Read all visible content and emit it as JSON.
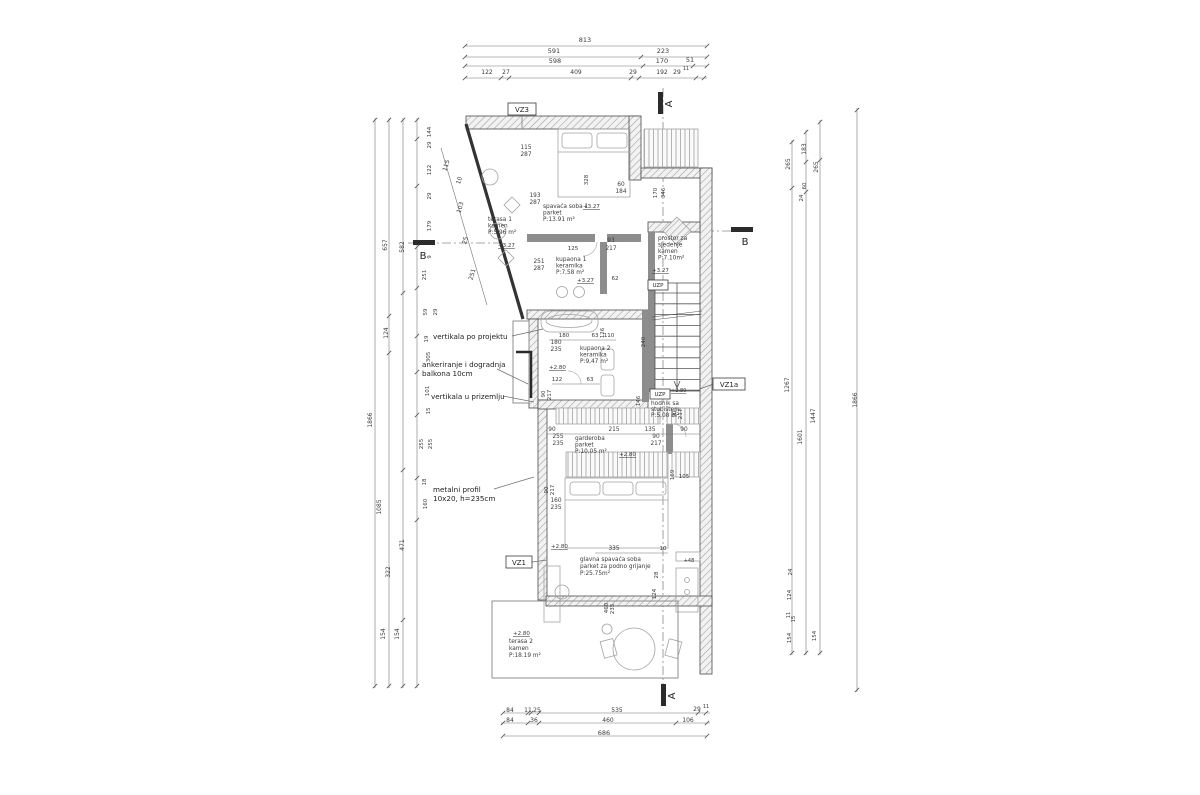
{
  "drawing": {
    "type": "floor-plan",
    "language": "hr"
  },
  "colors": {
    "text": "#3a3a3a",
    "dark": "#222222",
    "line": "#6e6e6e",
    "wall": "#4a4a4a",
    "light": "#a9a9a9",
    "accent": "#000000"
  },
  "dim_labels": [
    {
      "t": "813",
      "x": 585,
      "y": 42,
      "s": 6.5
    },
    {
      "t": "591",
      "x": 554,
      "y": 53,
      "s": 6.5
    },
    {
      "t": "223",
      "x": 663,
      "y": 53,
      "s": 6.5
    },
    {
      "t": "598",
      "x": 555,
      "y": 63,
      "s": 6.5
    },
    {
      "t": "170",
      "x": 662,
      "y": 63,
      "s": 6.5
    },
    {
      "t": "51",
      "x": 690,
      "y": 62,
      "s": 6.5
    },
    {
      "t": "122",
      "x": 487,
      "y": 74,
      "s": 6
    },
    {
      "t": "27",
      "x": 506,
      "y": 74,
      "s": 6
    },
    {
      "t": "409",
      "x": 576,
      "y": 74,
      "s": 6
    },
    {
      "t": "29",
      "x": 633,
      "y": 74,
      "s": 6
    },
    {
      "t": "192",
      "x": 662,
      "y": 74,
      "s": 6
    },
    {
      "t": "29",
      "x": 677,
      "y": 74,
      "s": 6
    },
    {
      "t": "11",
      "x": 686,
      "y": 70,
      "s": 5
    },
    {
      "t": "84",
      "x": 510,
      "y": 712,
      "s": 6
    },
    {
      "t": "11",
      "x": 528,
      "y": 712,
      "s": 6
    },
    {
      "t": "25",
      "x": 537,
      "y": 712,
      "s": 6
    },
    {
      "t": "535",
      "x": 617,
      "y": 712,
      "s": 6
    },
    {
      "t": "29",
      "x": 697,
      "y": 711,
      "s": 6
    },
    {
      "t": "11",
      "x": 706,
      "y": 708,
      "s": 5
    },
    {
      "t": "84",
      "x": 510,
      "y": 722,
      "s": 6
    },
    {
      "t": "36",
      "x": 534,
      "y": 722,
      "s": 6
    },
    {
      "t": "460",
      "x": 608,
      "y": 722,
      "s": 6
    },
    {
      "t": "106",
      "x": 688,
      "y": 722,
      "s": 6
    },
    {
      "t": "686",
      "x": 604,
      "y": 735,
      "s": 6.5
    },
    {
      "t": "1866",
      "x": 372,
      "y": 420,
      "r": -90,
      "s": 6
    },
    {
      "t": "657",
      "x": 387,
      "y": 245,
      "r": -90,
      "s": 6
    },
    {
      "t": "124",
      "x": 388,
      "y": 333,
      "r": -90,
      "s": 6
    },
    {
      "t": "1085",
      "x": 381,
      "y": 507,
      "r": -90,
      "s": 6
    },
    {
      "t": "322",
      "x": 390,
      "y": 572,
      "r": -90,
      "s": 6
    },
    {
      "t": "154",
      "x": 385,
      "y": 634,
      "r": -90,
      "s": 6
    },
    {
      "t": "582",
      "x": 404,
      "y": 247,
      "r": -90,
      "s": 6
    },
    {
      "t": "471",
      "x": 404,
      "y": 545,
      "r": -90,
      "s": 6
    },
    {
      "t": "154",
      "x": 399,
      "y": 634,
      "r": -90,
      "s": 6
    },
    {
      "t": "144",
      "x": 431,
      "y": 132,
      "r": -90,
      "s": 5.5
    },
    {
      "t": "29",
      "x": 431,
      "y": 145,
      "r": -90,
      "s": 5.5
    },
    {
      "t": "122",
      "x": 431,
      "y": 170,
      "r": -90,
      "s": 5.5
    },
    {
      "t": "29",
      "x": 431,
      "y": 196,
      "r": -90,
      "s": 5.5
    },
    {
      "t": "179",
      "x": 431,
      "y": 226,
      "r": -90,
      "s": 5.5
    },
    {
      "t": "9",
      "x": 431,
      "y": 257,
      "r": -90,
      "s": 5.5
    },
    {
      "t": "251",
      "x": 426,
      "y": 275,
      "r": -90,
      "s": 5.5
    },
    {
      "t": "59",
      "x": 427,
      "y": 312,
      "r": -90,
      "s": 5.5
    },
    {
      "t": "29",
      "x": 437,
      "y": 312,
      "r": -90,
      "s": 5.5
    },
    {
      "t": "19",
      "x": 428,
      "y": 339,
      "r": -90,
      "s": 5.5
    },
    {
      "t": "305",
      "x": 430,
      "y": 357,
      "r": -90,
      "s": 5.5
    },
    {
      "t": "101",
      "x": 429,
      "y": 391,
      "r": -90,
      "s": 5.5
    },
    {
      "t": "15",
      "x": 430,
      "y": 411,
      "r": -90,
      "s": 5.5
    },
    {
      "t": "255",
      "x": 423,
      "y": 444,
      "r": -90,
      "s": 5.5
    },
    {
      "t": "255",
      "x": 432,
      "y": 444,
      "r": -90,
      "s": 5.5
    },
    {
      "t": "18",
      "x": 426,
      "y": 482,
      "r": -90,
      "s": 5.5
    },
    {
      "t": "160",
      "x": 427,
      "y": 504,
      "r": -90,
      "s": 5.5
    },
    {
      "t": "265",
      "x": 790,
      "y": 164,
      "r": -90,
      "s": 6
    },
    {
      "t": "183",
      "x": 806,
      "y": 149,
      "r": -90,
      "s": 6
    },
    {
      "t": "265",
      "x": 818,
      "y": 167,
      "r": -90,
      "s": 6
    },
    {
      "t": "60",
      "x": 806,
      "y": 186,
      "r": -90,
      "s": 5.5
    },
    {
      "t": "24",
      "x": 803,
      "y": 198,
      "r": -90,
      "s": 5.5
    },
    {
      "t": "1267",
      "x": 789,
      "y": 385,
      "r": -90,
      "s": 6
    },
    {
      "t": "1601",
      "x": 802,
      "y": 437,
      "r": -90,
      "s": 6
    },
    {
      "t": "1447",
      "x": 815,
      "y": 416,
      "r": -90,
      "s": 6
    },
    {
      "t": "1866",
      "x": 857,
      "y": 400,
      "r": -90,
      "s": 6
    },
    {
      "t": "24",
      "x": 792,
      "y": 572,
      "r": -90,
      "s": 5.5
    },
    {
      "t": "124",
      "x": 791,
      "y": 595,
      "r": -90,
      "s": 5.5
    },
    {
      "t": "11",
      "x": 790,
      "y": 615,
      "r": -90,
      "s": 5
    },
    {
      "t": "15",
      "x": 795,
      "y": 619,
      "r": -90,
      "s": 5
    },
    {
      "t": "154",
      "x": 791,
      "y": 638,
      "r": -90,
      "s": 5.5
    },
    {
      "t": "154",
      "x": 816,
      "y": 636,
      "r": -90,
      "s": 5.5
    },
    {
      "t": "115",
      "x": 448,
      "y": 166,
      "r": -73,
      "s": 6
    },
    {
      "t": "10",
      "x": 461,
      "y": 181,
      "r": -73,
      "s": 6
    },
    {
      "t": "103",
      "x": 462,
      "y": 208,
      "r": -73,
      "s": 6
    },
    {
      "t": "25",
      "x": 467,
      "y": 241,
      "r": -73,
      "s": 6
    },
    {
      "t": "251",
      "x": 474,
      "y": 275,
      "r": -73,
      "s": 6
    },
    {
      "t": "115",
      "x": 526,
      "y": 149,
      "s": 5.8
    },
    {
      "t": "287",
      "x": 526,
      "y": 156,
      "s": 5.8
    },
    {
      "t": "193",
      "x": 535,
      "y": 197,
      "s": 5.8
    },
    {
      "t": "287",
      "x": 535,
      "y": 204,
      "s": 5.8
    },
    {
      "t": "328",
      "x": 588,
      "y": 180,
      "r": -90,
      "s": 5.5
    },
    {
      "t": "60",
      "x": 621,
      "y": 186,
      "s": 5.8
    },
    {
      "t": "184",
      "x": 621,
      "y": 193,
      "s": 5.8
    },
    {
      "t": "170",
      "x": 657,
      "y": 193,
      "r": -90,
      "s": 5.5
    },
    {
      "t": "346",
      "x": 665,
      "y": 193,
      "r": -90,
      "s": 5.5
    },
    {
      "t": "251",
      "x": 539,
      "y": 263,
      "s": 5.8
    },
    {
      "t": "287",
      "x": 539,
      "y": 270,
      "s": 5.8
    },
    {
      "t": "125",
      "x": 573,
      "y": 250,
      "s": 5.5
    },
    {
      "t": "93",
      "x": 611,
      "y": 242,
      "s": 5.8
    },
    {
      "t": "217",
      "x": 611,
      "y": 250,
      "s": 5.8
    },
    {
      "t": "62",
      "x": 615,
      "y": 280,
      "s": 5.5
    },
    {
      "t": "180",
      "x": 564,
      "y": 337,
      "s": 5.5
    },
    {
      "t": "63",
      "x": 595,
      "y": 337,
      "s": 5.5
    },
    {
      "t": "110",
      "x": 609,
      "y": 337,
      "s": 5.5
    },
    {
      "t": "126",
      "x": 604,
      "y": 333,
      "r": -90,
      "s": 5.5
    },
    {
      "t": "240",
      "x": 645,
      "y": 342,
      "r": -90,
      "s": 5.5
    },
    {
      "t": "180",
      "x": 556,
      "y": 344,
      "s": 5.8
    },
    {
      "t": "235",
      "x": 556,
      "y": 351,
      "s": 5.8
    },
    {
      "t": "122",
      "x": 557,
      "y": 381,
      "s": 5.5
    },
    {
      "t": "63",
      "x": 590,
      "y": 381,
      "s": 5.5
    },
    {
      "t": "90",
      "x": 545,
      "y": 394,
      "r": -90,
      "s": 5.5
    },
    {
      "t": "217",
      "x": 551,
      "y": 395,
      "r": -90,
      "s": 5.5
    },
    {
      "t": "146",
      "x": 640,
      "y": 401,
      "r": -90,
      "s": 5.5
    },
    {
      "t": "90",
      "x": 676,
      "y": 414,
      "r": -90,
      "s": 5.5
    },
    {
      "t": "217",
      "x": 682,
      "y": 414,
      "r": -90,
      "s": 5.5
    },
    {
      "t": "90",
      "x": 552,
      "y": 431,
      "s": 5.8
    },
    {
      "t": "215",
      "x": 614,
      "y": 431,
      "s": 5.8
    },
    {
      "t": "135",
      "x": 650,
      "y": 431,
      "s": 5.8
    },
    {
      "t": "90",
      "x": 684,
      "y": 431,
      "s": 5.8
    },
    {
      "t": "255",
      "x": 558,
      "y": 438,
      "s": 5.8
    },
    {
      "t": "235",
      "x": 558,
      "y": 445,
      "s": 5.8
    },
    {
      "t": "90",
      "x": 656,
      "y": 438,
      "s": 5.8
    },
    {
      "t": "217",
      "x": 656,
      "y": 445,
      "s": 5.8
    },
    {
      "t": "169",
      "x": 674,
      "y": 475,
      "r": -90,
      "s": 5.5
    },
    {
      "t": "105",
      "x": 684,
      "y": 478,
      "s": 5.5
    },
    {
      "t": "90",
      "x": 548,
      "y": 490,
      "r": -90,
      "s": 5.5
    },
    {
      "t": "217",
      "x": 554,
      "y": 490,
      "r": -90,
      "s": 5.5
    },
    {
      "t": "160",
      "x": 556,
      "y": 502,
      "s": 5.8
    },
    {
      "t": "235",
      "x": 556,
      "y": 509,
      "s": 5.8
    },
    {
      "t": "335",
      "x": 614,
      "y": 550,
      "s": 5.8
    },
    {
      "t": "10",
      "x": 663,
      "y": 550,
      "s": 5.5
    },
    {
      "t": "+48",
      "x": 689,
      "y": 562,
      "s": 5
    },
    {
      "t": "28",
      "x": 658,
      "y": 575,
      "r": -90,
      "s": 5.5
    },
    {
      "t": "124",
      "x": 656,
      "y": 594,
      "r": -90,
      "s": 5.5
    },
    {
      "t": "460",
      "x": 608,
      "y": 608,
      "r": -90,
      "s": 5.5
    },
    {
      "t": "235",
      "x": 614,
      "y": 609,
      "r": -90,
      "s": 5.5
    }
  ],
  "rooms": [
    {
      "x": 488,
      "y": 221,
      "lh": 6.5,
      "lines": [
        "terasa 1",
        "kamen",
        "P:5.96 m²"
      ]
    },
    {
      "x": 543,
      "y": 208,
      "lh": 6.5,
      "lines": [
        "spavaća soba 1",
        "parket",
        "P:13.91 m²"
      ]
    },
    {
      "x": 556,
      "y": 261,
      "lh": 6.5,
      "lines": [
        "kupaona 1",
        "keramika",
        "P:7,58 m²"
      ]
    },
    {
      "x": 658,
      "y": 240,
      "lh": 6.5,
      "lines": [
        "prostor za",
        "sjedenje",
        "kamen",
        "P:7.10m²"
      ]
    },
    {
      "x": 580,
      "y": 350,
      "lh": 6.5,
      "lines": [
        "kupaona 2",
        "keramika",
        "P:9,47 m²"
      ]
    },
    {
      "x": 651,
      "y": 405,
      "lh": 6,
      "lines": [
        "hodnik sa",
        "stubištem",
        "P:5,08 m²"
      ]
    },
    {
      "x": 575,
      "y": 440,
      "lh": 6.5,
      "lines": [
        "garderoba",
        "parket",
        "P:10,05 m²"
      ]
    },
    {
      "x": 580,
      "y": 561,
      "lh": 7,
      "lines": [
        "glavna spavaća soba",
        "parket za podno grijanje",
        "P:25.75m²"
      ]
    },
    {
      "x": 509,
      "y": 643,
      "lh": 7,
      "lines": [
        "terasa 2",
        "kamen",
        "P:18.19 m²"
      ]
    }
  ],
  "annotations": [
    {
      "x": 433,
      "y": 339,
      "lh": 9,
      "lines": [
        "vertikala po projektu"
      ]
    },
    {
      "x": 422,
      "y": 367,
      "lh": 9,
      "lines": [
        "ankeriranje i dogradnja",
        "balkona 10cm"
      ]
    },
    {
      "x": 431,
      "y": 399,
      "lh": 9,
      "lines": [
        "vertikala u prizemlju"
      ]
    },
    {
      "x": 433,
      "y": 492,
      "lh": 9,
      "lines": [
        "metalni profil",
        "10x20, h=235cm"
      ]
    }
  ],
  "elevations": [
    {
      "t": "+3.27",
      "x": 583,
      "y": 208
    },
    {
      "t": "+3.27",
      "x": 498,
      "y": 247
    },
    {
      "t": "+3.27",
      "x": 577,
      "y": 282
    },
    {
      "t": "+3.27",
      "x": 652,
      "y": 272
    },
    {
      "t": "+2.80",
      "x": 549,
      "y": 369
    },
    {
      "t": "+2.80",
      "x": 671,
      "y": 392,
      "s": 5
    },
    {
      "t": "+2.80",
      "x": 619,
      "y": 456
    },
    {
      "t": "+2.80",
      "x": 551,
      "y": 548
    },
    {
      "t": "+2.80",
      "x": 513,
      "y": 635
    }
  ],
  "boxed_labels": [
    {
      "t": "VZ3",
      "x": 508,
      "y": 103,
      "w": 28,
      "h": 12
    },
    {
      "t": "VZ1a",
      "x": 713,
      "y": 378,
      "w": 32,
      "h": 12
    },
    {
      "t": "VZ1",
      "x": 506,
      "y": 556,
      "w": 26,
      "h": 12
    },
    {
      "t": "UZP",
      "x": 648,
      "y": 280,
      "w": 20,
      "h": 10,
      "s": 5.5
    },
    {
      "t": "UZP",
      "x": 650,
      "y": 389,
      "w": 20,
      "h": 10,
      "s": 5.5
    }
  ],
  "section_marks": [
    {
      "t": "A",
      "x": 672,
      "y": 104,
      "r": -90
    },
    {
      "t": "A",
      "x": 675,
      "y": 696,
      "r": -90
    },
    {
      "t": "B",
      "x": 423,
      "y": 259,
      "r": 0
    },
    {
      "t": "B",
      "x": 745,
      "y": 245,
      "r": 0
    }
  ]
}
